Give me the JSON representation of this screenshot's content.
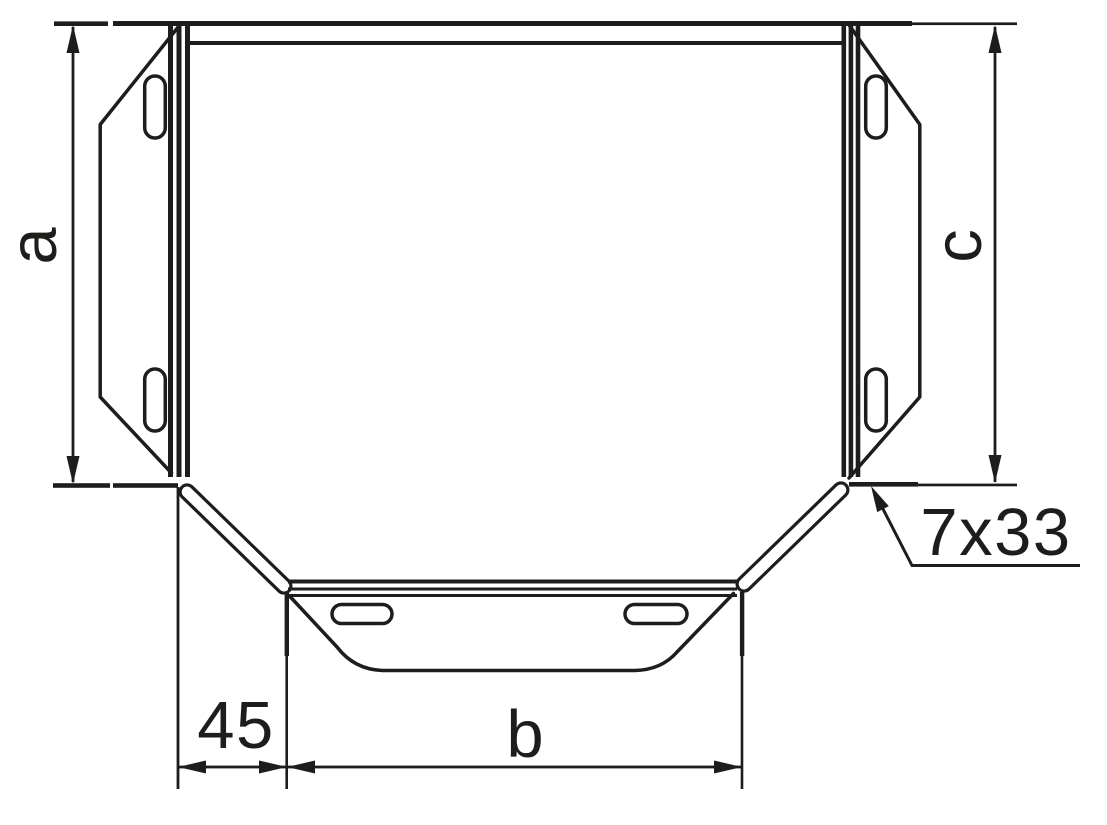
{
  "figure": {
    "kind": "technical line drawing",
    "subject": "cable tray tee piece, top view with flanged branch ends and slotted connector plates",
    "background": "#ffffff",
    "line_color": "#1d1d1b"
  },
  "labels": {
    "dim_left": "a",
    "dim_right": "c",
    "dim_corner_offset": "45",
    "dim_bottom_width": "b",
    "slot_callout": "7x33"
  }
}
